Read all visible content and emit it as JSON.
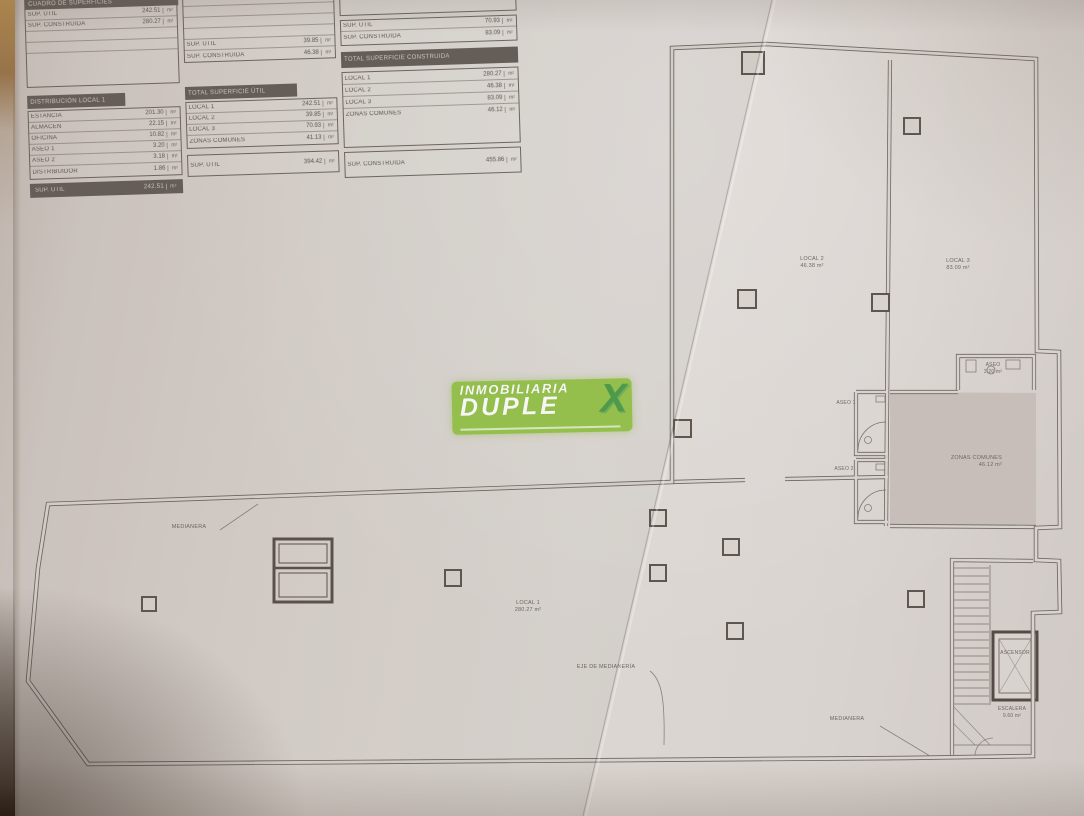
{
  "logo": {
    "top": "INMOBILIARIA",
    "main": "DUPLE",
    "x": "X"
  },
  "tables": {
    "a": {
      "title": "CUADRO DE SUPERFICIES",
      "top_rows": [
        {
          "label": "SUP. ÚTIL",
          "value": "242.51",
          "unit": "m²"
        },
        {
          "label": "SUP. CONSTRUIDA",
          "value": "280.27",
          "unit": "m²"
        },
        {
          "label": "",
          "value": "",
          "unit": "m²"
        },
        {
          "label": "",
          "value": "",
          "unit": "m²"
        },
        {
          "label": "",
          "value": "",
          "unit": "m²"
        }
      ],
      "header": "DISTRIBUCIÓN LOCAL 1",
      "rows": [
        {
          "label": "ESTANCIA",
          "value": "201.30",
          "unit": "m²"
        },
        {
          "label": "ALMACÉN",
          "value": "22.15",
          "unit": "m²"
        },
        {
          "label": "OFICINA",
          "value": "10.82",
          "unit": "m²"
        },
        {
          "label": "ASEO 1",
          "value": "3.20",
          "unit": "m²"
        },
        {
          "label": "ASEO 2",
          "value": "3.18",
          "unit": "m²"
        },
        {
          "label": "DISTRIBUIDOR",
          "value": "1.86",
          "unit": "m²"
        }
      ],
      "footer": {
        "label": "SUP. ÚTIL",
        "value": "242.51",
        "unit": "m²"
      }
    },
    "b": {
      "top_rows": [
        {
          "label": "",
          "value": "",
          "unit": ""
        },
        {
          "label": "",
          "value": "",
          "unit": ""
        },
        {
          "label": "",
          "value": "",
          "unit": ""
        },
        {
          "label": "",
          "value": "",
          "unit": ""
        },
        {
          "label": "SUP. ÚTIL",
          "value": "39.85",
          "unit": "m²"
        },
        {
          "label": "SUP. CONSTRUIDA",
          "value": "46.38",
          "unit": "m²"
        }
      ],
      "header": "TOTAL SUPERFICIE ÚTIL",
      "rows": [
        {
          "label": "LOCAL 1",
          "value": "242.51",
          "unit": "m²"
        },
        {
          "label": "LOCAL 2",
          "value": "39.85",
          "unit": "m²"
        },
        {
          "label": "LOCAL 3",
          "value": "70.93",
          "unit": "m²"
        },
        {
          "label": "ZONAS COMUNES",
          "value": "41.13",
          "unit": "m²"
        }
      ],
      "footer": {
        "label": "SUP. ÚTIL",
        "value": "394.42",
        "unit": "m²"
      }
    },
    "c": {
      "top_rows": [
        {
          "label": "SUP. ÚTIL",
          "value": "70.93",
          "unit": "m²"
        },
        {
          "label": "SUP. CONSTRUIDA",
          "value": "83.09",
          "unit": "m²"
        }
      ],
      "header": "TOTAL SUPERFICIE CONSTRUIDA",
      "rows": [
        {
          "label": "LOCAL 1",
          "value": "280.27",
          "unit": "m²"
        },
        {
          "label": "LOCAL 2",
          "value": "46.38",
          "unit": "m²"
        },
        {
          "label": "LOCAL 3",
          "value": "83.09",
          "unit": "m²"
        },
        {
          "label": "ZONAS COMUNES",
          "value": "46.12",
          "unit": "m²"
        }
      ],
      "footer": {
        "label": "SUP. CONSTRUIDA",
        "value": "455.86",
        "unit": "m²"
      }
    }
  },
  "plan": {
    "labels": {
      "local1": {
        "name": "LOCAL 1",
        "area": "280.27 m²"
      },
      "local2": {
        "name": "LOCAL 2",
        "area": "46.38 m²"
      },
      "local3": {
        "name": "LOCAL 3",
        "area": "83.09 m²"
      },
      "zonas": {
        "name": "ZONAS COMUNES",
        "area": "46.12 m²"
      },
      "aseo_top": {
        "name": "ASEO",
        "area": "3.20 m²"
      },
      "aseo1": "ASEO 1",
      "aseo2": "ASEO 2",
      "ascensor": "ASCENSOR",
      "escalera": {
        "name": "ESCALERA",
        "area": "9.60 m²"
      },
      "medianera_left": "MEDIANERA",
      "eje": "EJE DE MEDIANERÍA",
      "medianera_bottom": "MEDIANERA"
    }
  },
  "colors": {
    "paper": "#d9d2cd",
    "wall_line": "#6e6560",
    "logo_green": "#98c54d",
    "logo_x_green": "#4f9d4c",
    "common_zone_shade": "#c9c0bb"
  }
}
